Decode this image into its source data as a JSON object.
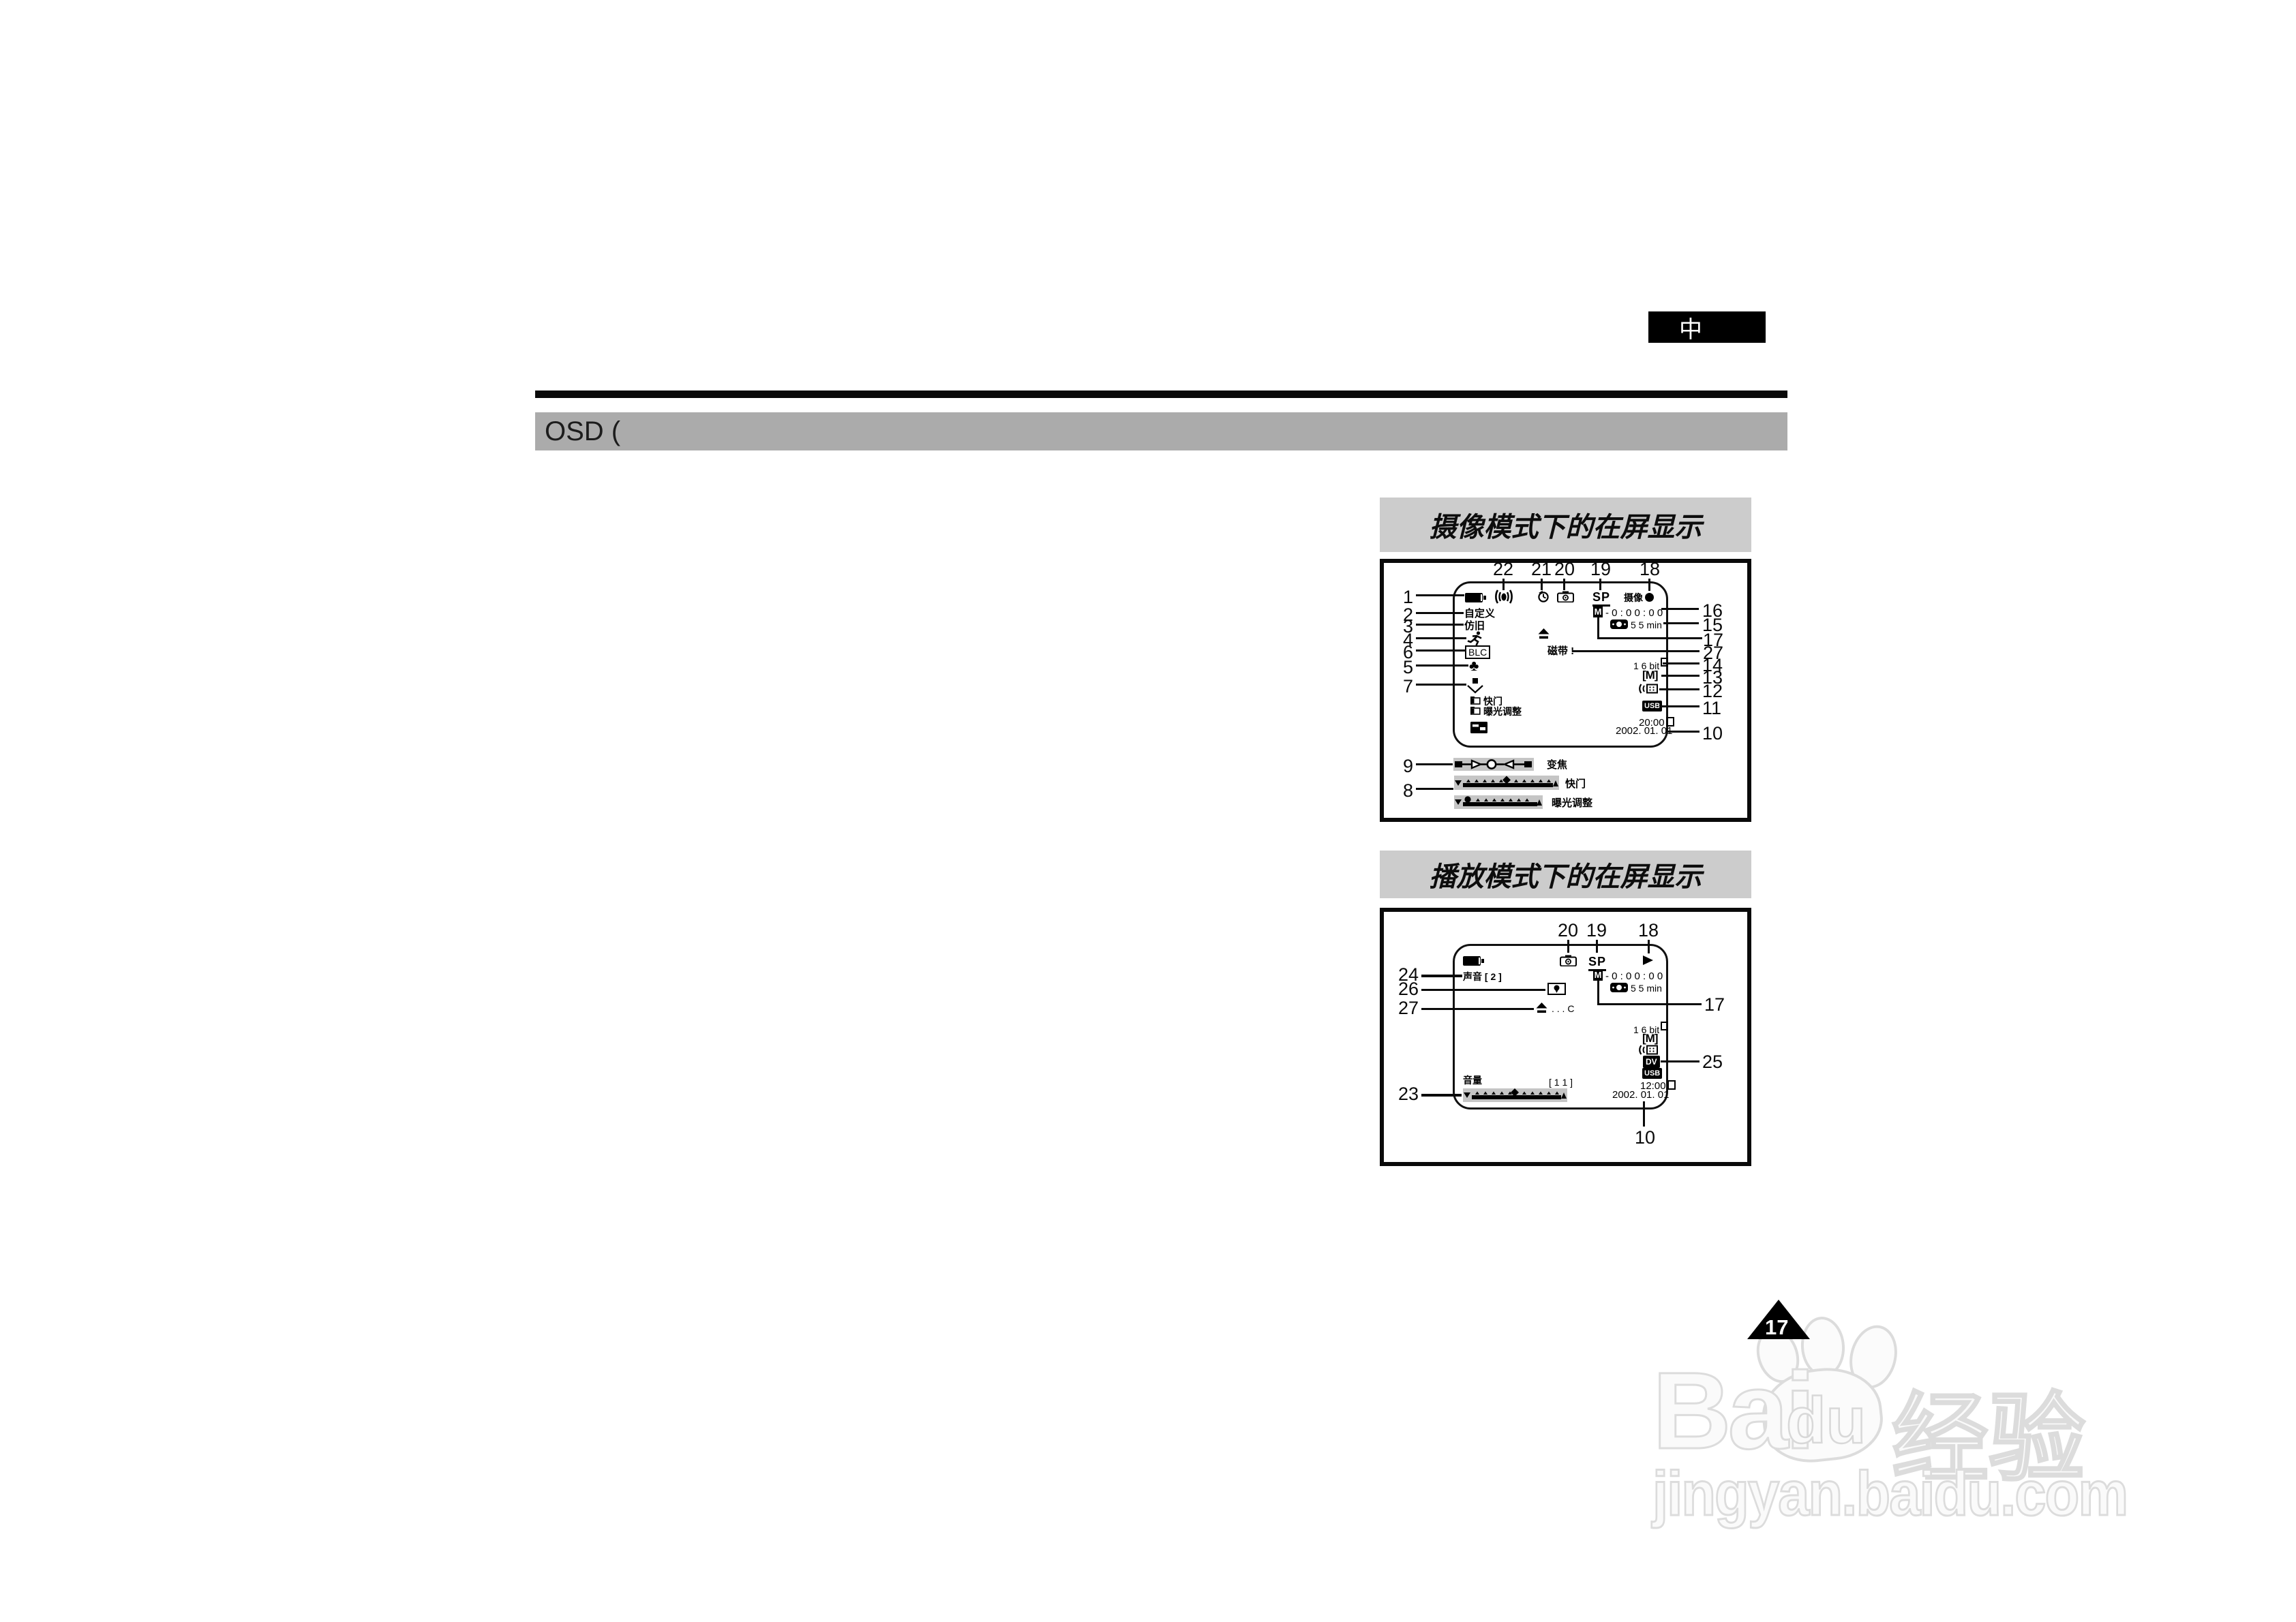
{
  "badge": {
    "label": "中"
  },
  "header": {
    "label": "OSD ("
  },
  "camera_osd": {
    "title": "摄像模式下的在屏显示",
    "top_callouts": [
      "22",
      "21",
      "20",
      "19",
      "18"
    ],
    "left_callouts": [
      "1",
      "2",
      "3",
      "4",
      "6",
      "5",
      "7",
      "9",
      "8"
    ],
    "right_callouts": [
      "16",
      "15",
      "17",
      "27",
      "14",
      "13",
      "12",
      "11",
      "10"
    ],
    "screen": {
      "sp": "SP",
      "rec": "摄像",
      "custom": "自定义",
      "sepia": "仿旧",
      "blc": "BLC",
      "mem": "M",
      "counter": "- 0 : 0 0 : 0 0",
      "remain": "5 5 min",
      "tape_warn": "磁带 !",
      "audio": "1 6 bit",
      "usb": "USB",
      "time": "20:00",
      "date": "2002. 01. 01",
      "menu_shutter": "快门",
      "menu_exposure": "曝光调整"
    },
    "bars": {
      "zoom_label": "变焦",
      "shutter_label": "快门",
      "exposure_label": "曝光调整"
    }
  },
  "playback_osd": {
    "title": "播放模式下的在屏显示",
    "top_callouts": [
      "20",
      "19",
      "18"
    ],
    "left_callouts": [
      "24",
      "26",
      "27",
      "23"
    ],
    "right_callouts": [
      "17",
      "25",
      "10"
    ],
    "screen": {
      "sp": "SP",
      "sound": "声音 [ 2 ]",
      "mem": "M",
      "counter": "- 0 : 0 0 : 0 0",
      "remain": "5 5 min",
      "eject_note": ". . . C",
      "audio": "1 6 bit",
      "dv": "DV",
      "usb": "USB",
      "time": "12:00",
      "date": "2002. 01. 01",
      "volume_label": "音量",
      "volume_value": "[ 1 1 ]"
    }
  },
  "page_marker": {
    "number": "17"
  },
  "watermark": {
    "brand_a": "Bai",
    "brand_b": "du",
    "brand_c": "经验",
    "url": "jingyan.baidu.com"
  },
  "icons": {
    "battery-icon": "filled battery",
    "stabilizer-icon": "(( ))",
    "self-timer-icon": "clock",
    "photo-camera-icon": "camera",
    "record-dot-icon": "●",
    "play-icon": "▶",
    "eject-icon": "⏏",
    "runner-icon": "running man",
    "clover-icon": "♣",
    "tape-end-icon": "square over envelope",
    "folder-icon": "▣",
    "memory-card-icon": "black card",
    "tape-icon": "cassette",
    "audio-dub-icon": "(( grid",
    "photo-search-icon": "framed blob",
    "paw-icon": "baidu paw"
  },
  "colors": {
    "header_bar": "#ababab",
    "title_bar": "#cccccc",
    "slider_bg": "#c5c5c5",
    "badge_bg": "#000000",
    "ink": "#0a0a0a"
  }
}
